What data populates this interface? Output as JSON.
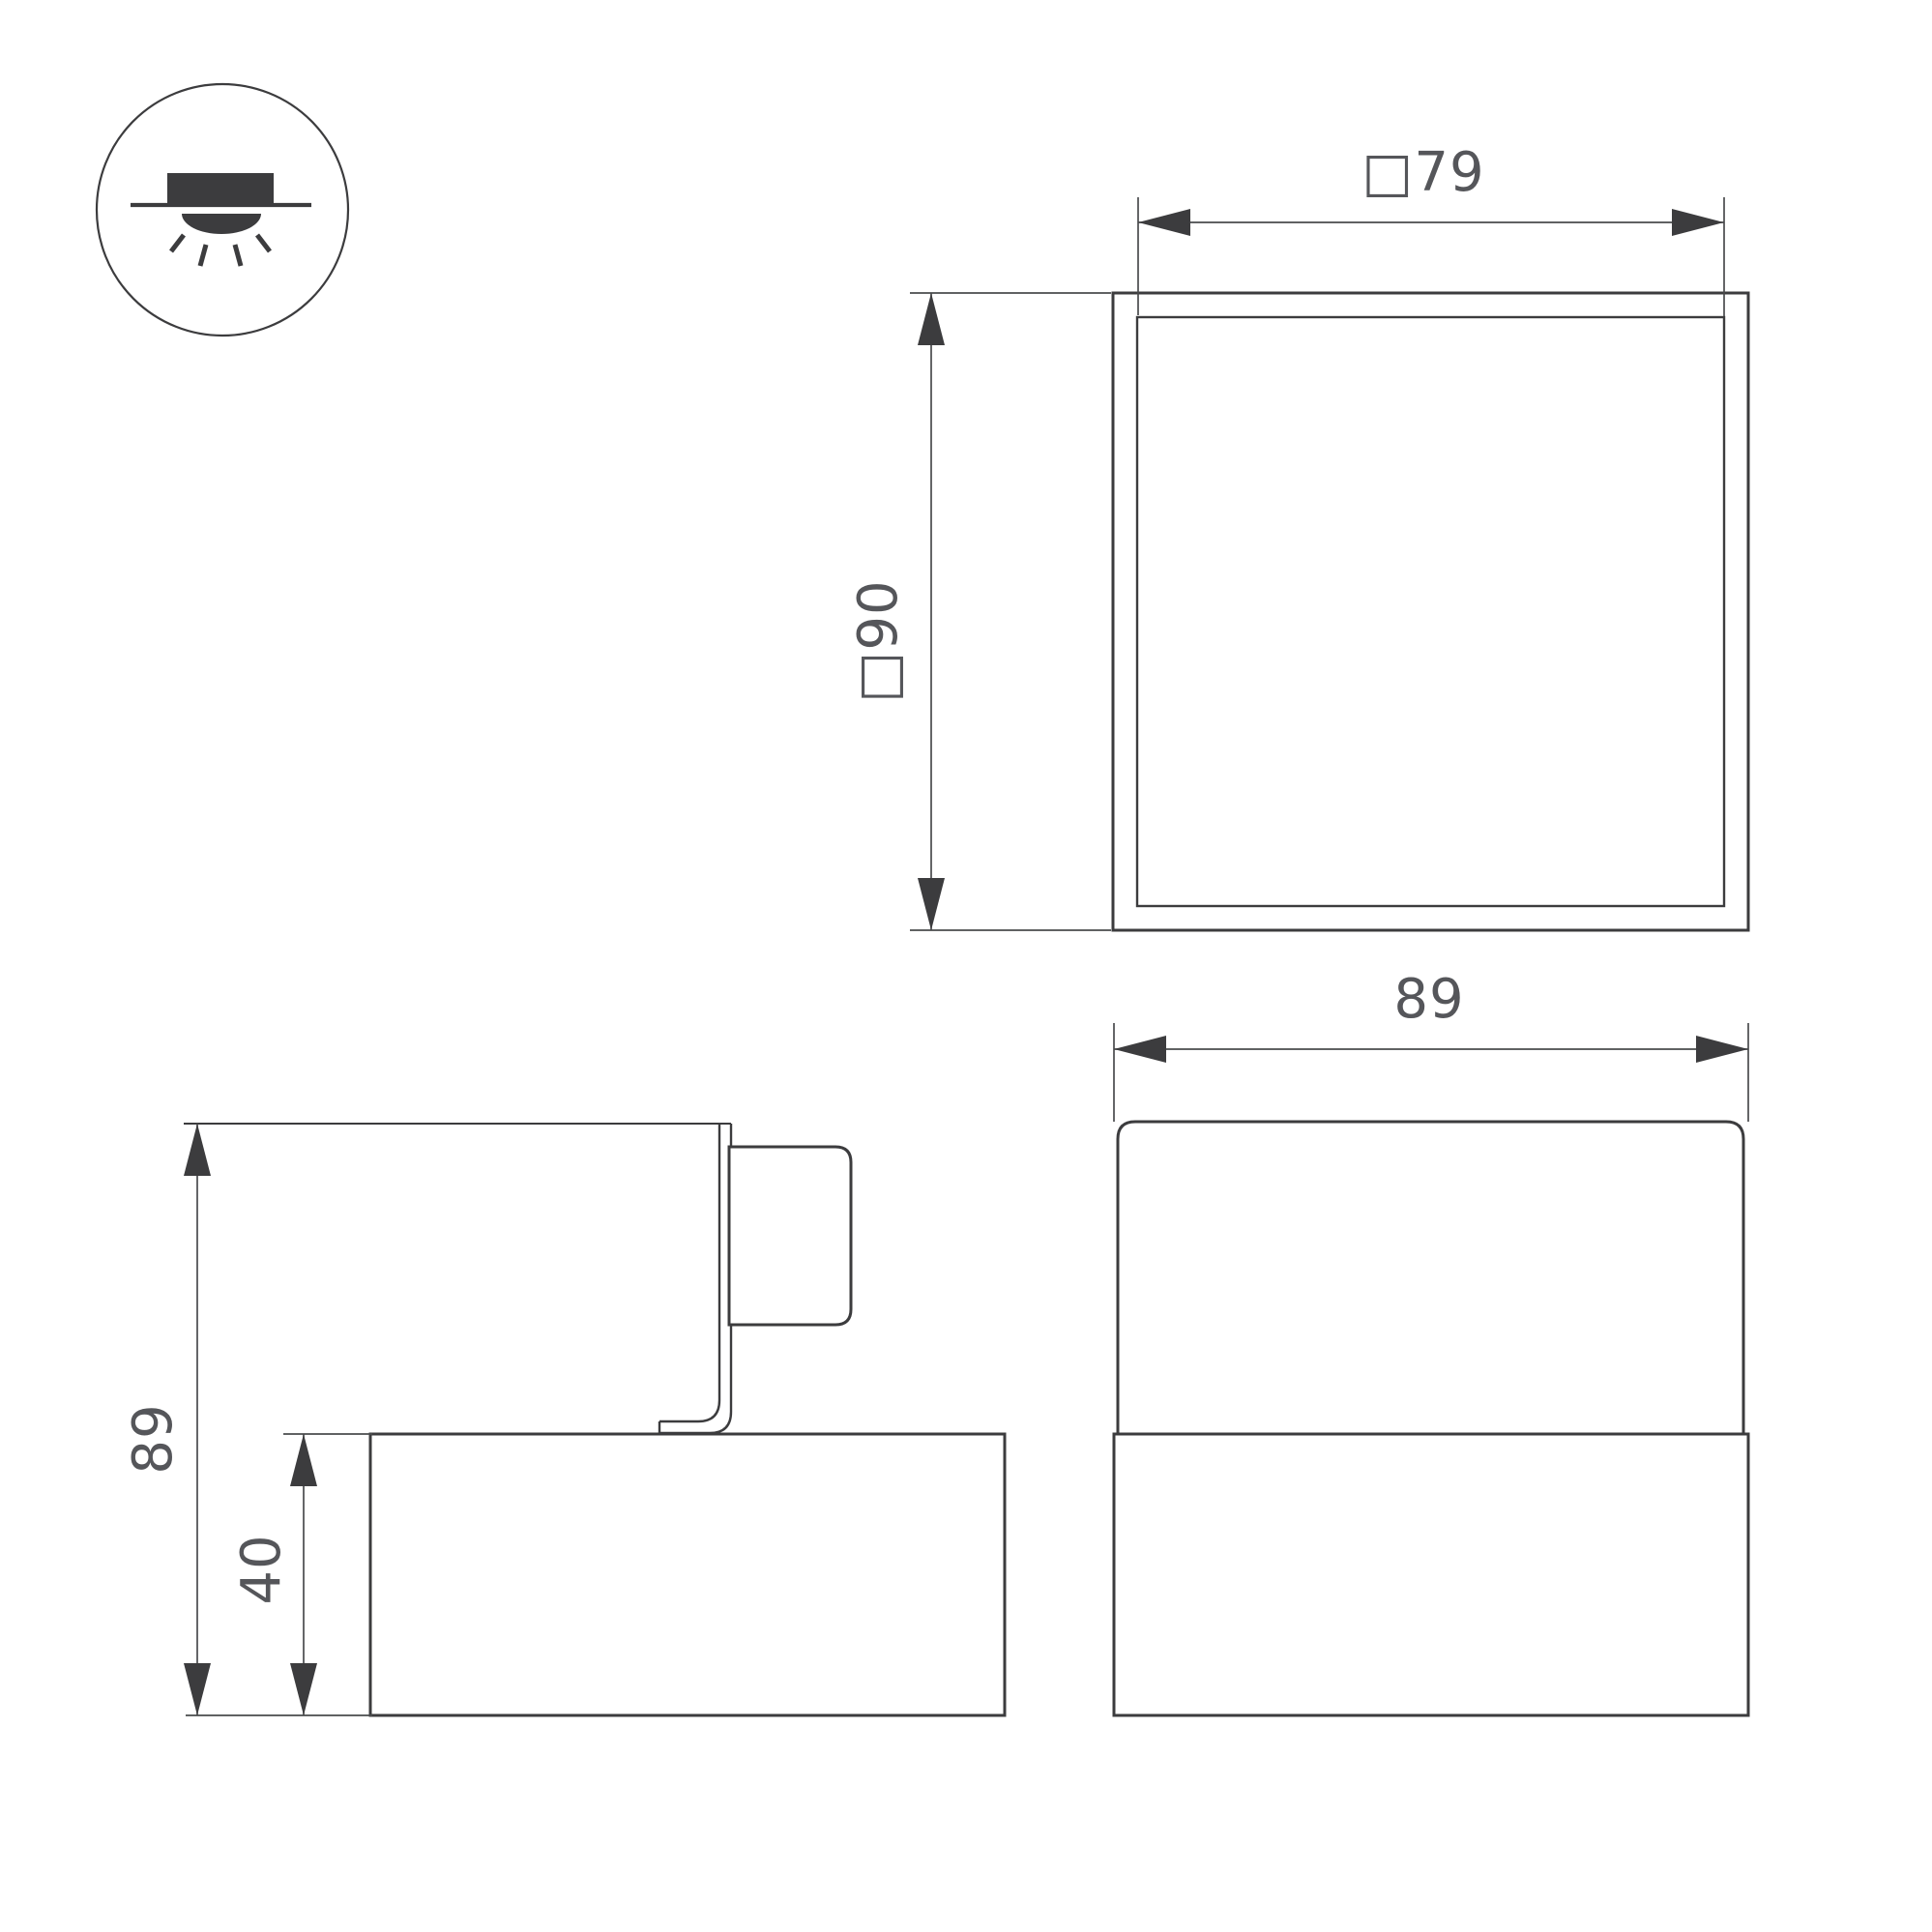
{
  "page": {
    "background_color": "#ffffff",
    "line_color": "#3c3c3e",
    "text_color": "#55565a"
  },
  "mount_icon": {
    "name": "surface-mounted-downlight-icon"
  },
  "top_view": {
    "width_label": "□79",
    "height_label": "□90"
  },
  "side_view": {
    "overall_height_label": "89",
    "base_height_label": "40"
  },
  "front_view": {
    "overall_width_label": "89"
  }
}
